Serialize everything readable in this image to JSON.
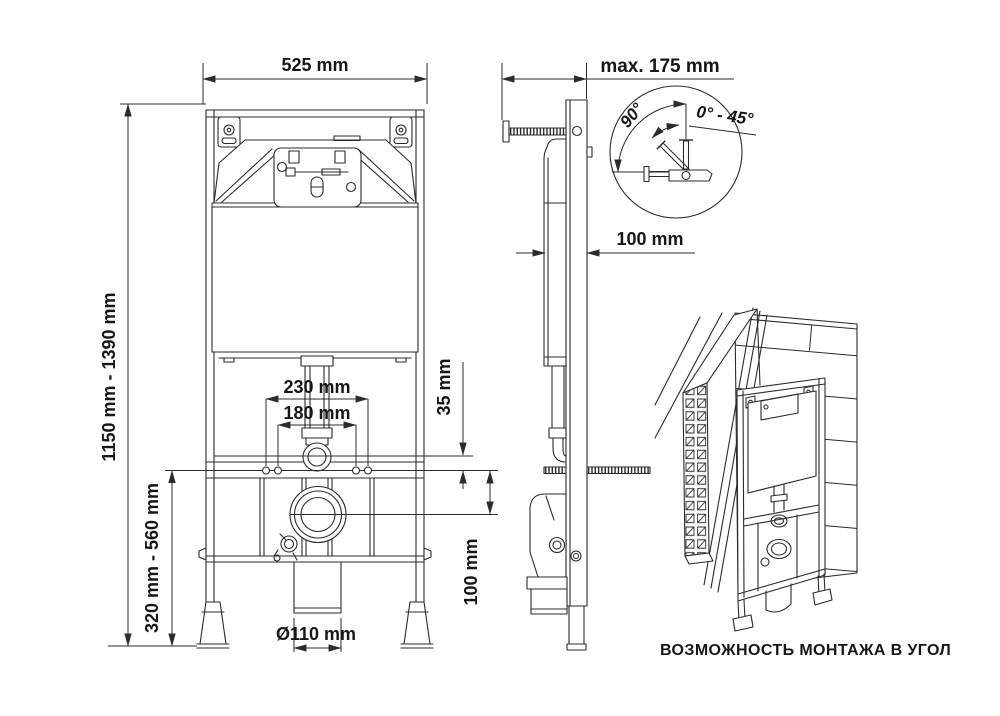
{
  "drawing": {
    "front_view": {
      "dim_width": "525 mm",
      "dim_height_range": "1150 mm - 1390 mm",
      "dim_seat_range": "320 mm - 560 mm",
      "dim_bolt_outer": "230 mm",
      "dim_bolt_inner": "180 mm",
      "dim_drain_diameter": "Ø110 mm"
    },
    "side_view": {
      "dim_wall_max": "max. 175 mm",
      "dim_frame_depth": "100 mm",
      "dim_flush_offset": "35 mm",
      "dim_outlet_offset": "100 mm"
    },
    "angle_detail": {
      "angle_sweep": "90°",
      "angle_range": "0° - 45°"
    },
    "isometric_view": {
      "caption": "ВОЗМОЖНОСТЬ МОНТАЖА В УГОЛ"
    },
    "colors": {
      "line": "#2b2b2b",
      "background": "#ffffff"
    }
  }
}
